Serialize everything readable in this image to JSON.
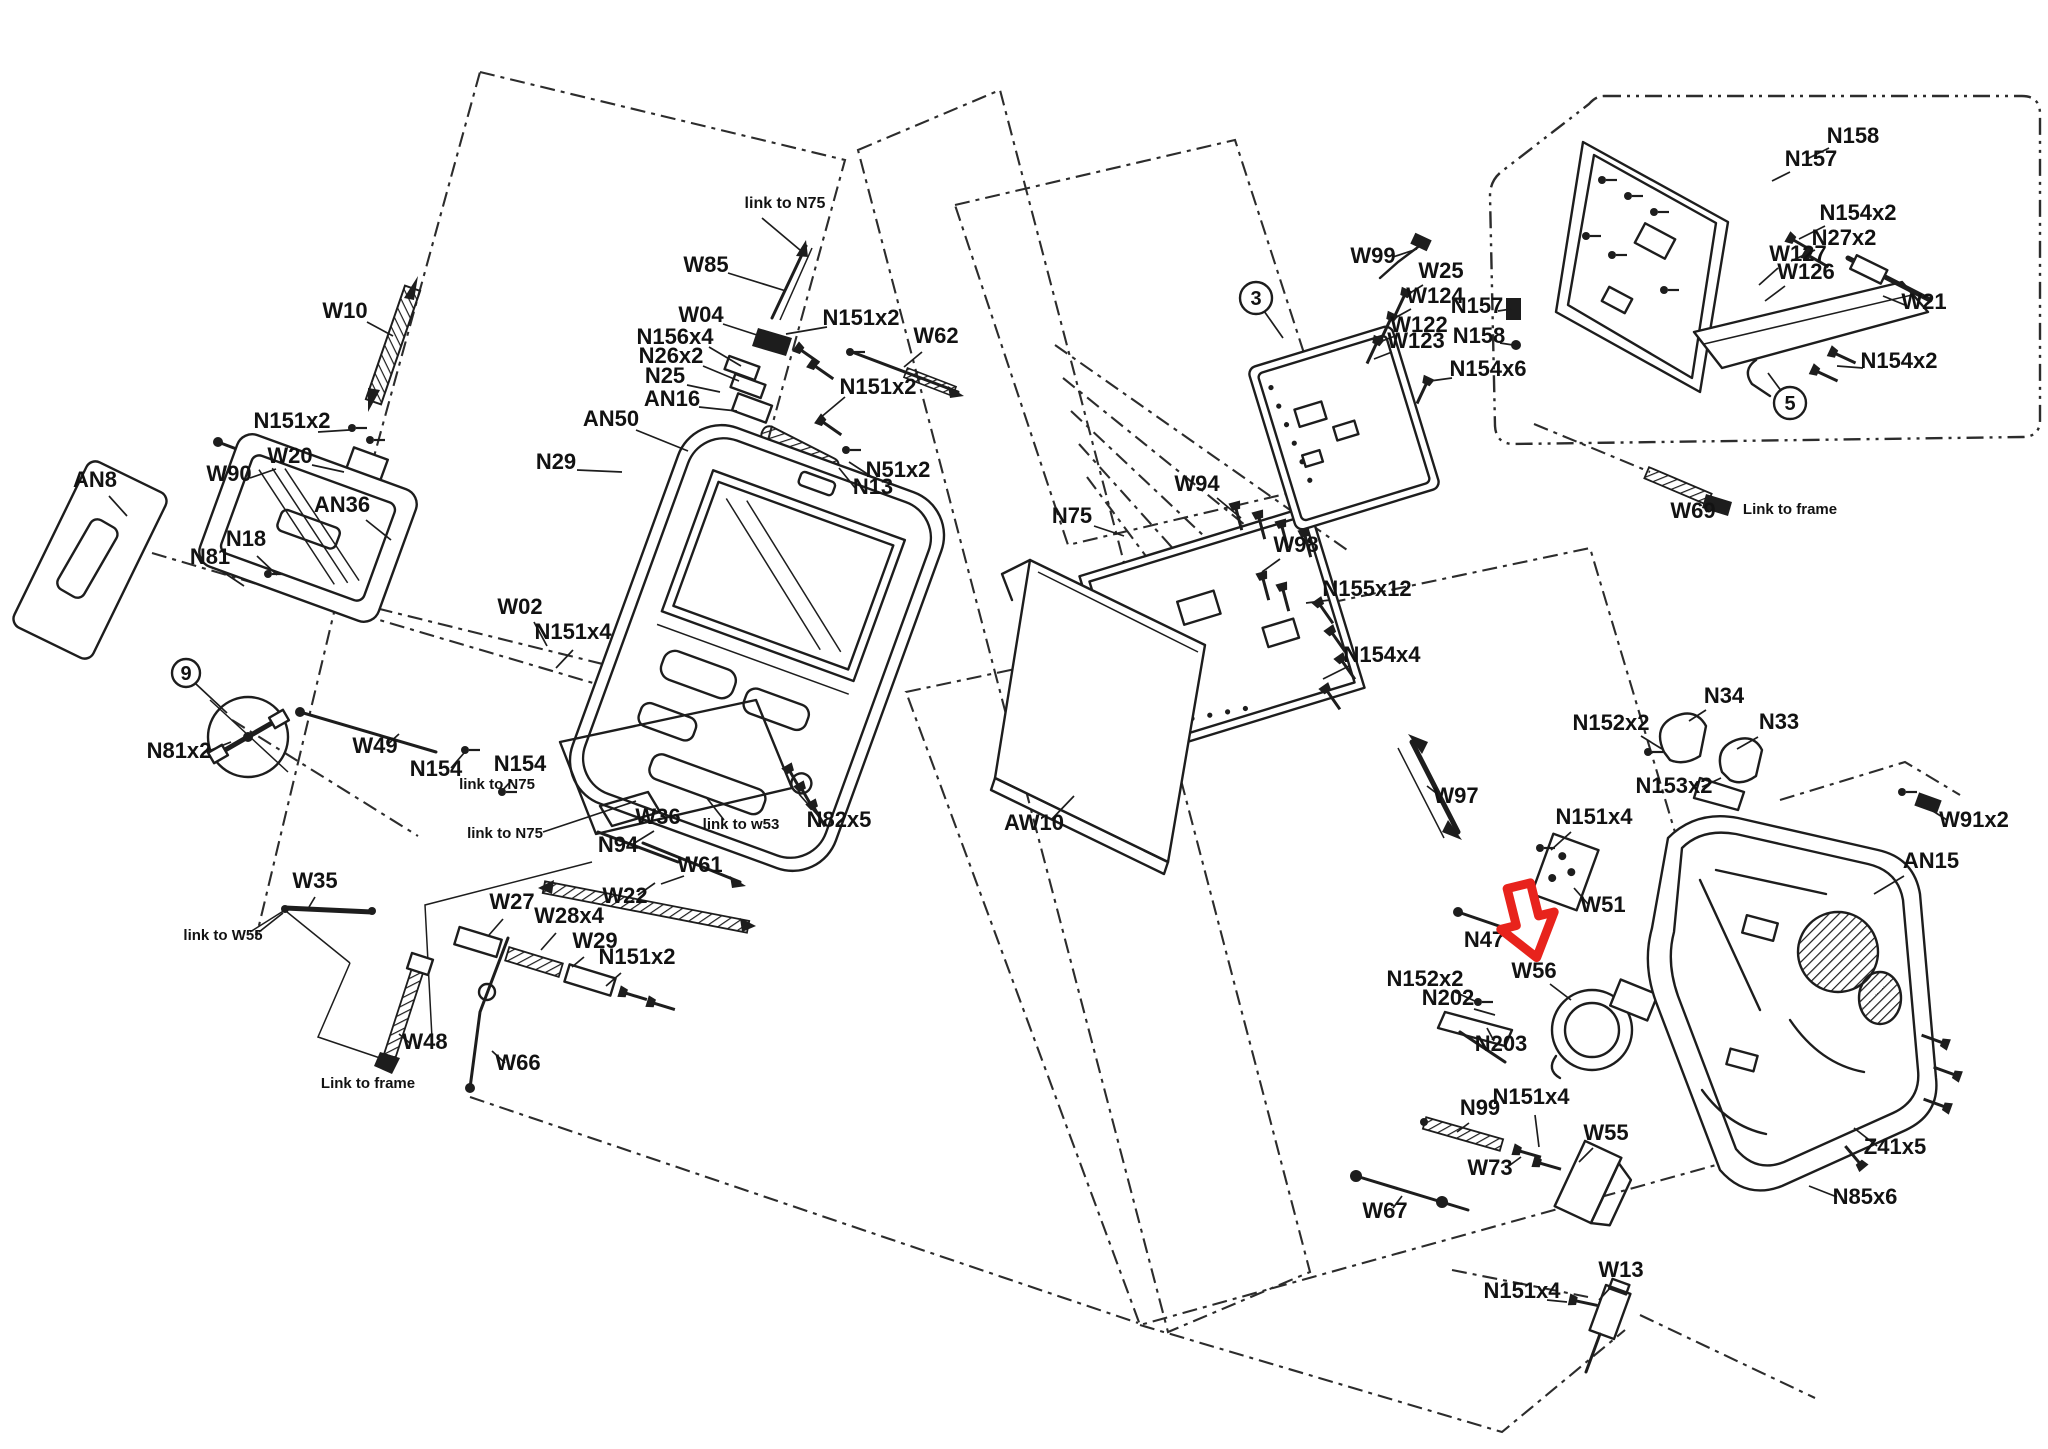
{
  "figure": {
    "type": "exploded-parts-diagram",
    "background": "#ffffff",
    "ink_color": "#1d1d1d",
    "highlight_color": "#e8231c",
    "highlighted_part": "W56"
  },
  "red_arrow": {
    "x": 1527,
    "y": 927,
    "rotate": -14
  },
  "callouts": [
    {
      "t": "3",
      "x": 1256,
      "y": 298,
      "r": 16
    },
    {
      "t": "5",
      "x": 1790,
      "y": 403,
      "r": 16
    },
    {
      "t": "9",
      "x": 186,
      "y": 673,
      "r": 14
    }
  ],
  "callout_leaders": [
    [
      1264,
      311,
      1283,
      338
    ],
    [
      1782,
      392,
      1768,
      373
    ],
    [
      196,
      684,
      227,
      713
    ]
  ],
  "labels": [
    {
      "t": "link to N75",
      "x": 785,
      "y": 208,
      "s": 16
    },
    {
      "t": "W85",
      "x": 706,
      "y": 272,
      "s": 22
    },
    {
      "t": "W10",
      "x": 345,
      "y": 318,
      "s": 22
    },
    {
      "t": "W04",
      "x": 701,
      "y": 322,
      "s": 22
    },
    {
      "t": "N151x2",
      "x": 861,
      "y": 325,
      "s": 22
    },
    {
      "t": "W62",
      "x": 936,
      "y": 343,
      "s": 22
    },
    {
      "t": "N156x4",
      "x": 675,
      "y": 344,
      "s": 22
    },
    {
      "t": "N26x2",
      "x": 671,
      "y": 363,
      "s": 22
    },
    {
      "t": "N25",
      "x": 665,
      "y": 383,
      "s": 22
    },
    {
      "t": "AN16",
      "x": 672,
      "y": 406,
      "s": 22
    },
    {
      "t": "N151x2",
      "x": 878,
      "y": 394,
      "s": 22
    },
    {
      "t": "AN50",
      "x": 611,
      "y": 426,
      "s": 22
    },
    {
      "t": "N29",
      "x": 556,
      "y": 469,
      "s": 22
    },
    {
      "t": "N51x2",
      "x": 898,
      "y": 477,
      "s": 22
    },
    {
      "t": "N13",
      "x": 873,
      "y": 494,
      "s": 22
    },
    {
      "t": "N151x2",
      "x": 292,
      "y": 428,
      "s": 22
    },
    {
      "t": "W20",
      "x": 290,
      "y": 463,
      "s": 22
    },
    {
      "t": "W90",
      "x": 229,
      "y": 481,
      "s": 22
    },
    {
      "t": "AN8",
      "x": 95,
      "y": 487,
      "s": 22
    },
    {
      "t": "N18",
      "x": 246,
      "y": 546,
      "s": 22
    },
    {
      "t": "N81",
      "x": 210,
      "y": 564,
      "s": 22
    },
    {
      "t": "AN36",
      "x": 342,
      "y": 512,
      "s": 22
    },
    {
      "t": "W02",
      "x": 520,
      "y": 614,
      "s": 22
    },
    {
      "t": "N151x4",
      "x": 573,
      "y": 639,
      "s": 22
    },
    {
      "t": "N81x2",
      "x": 179,
      "y": 758,
      "s": 22
    },
    {
      "t": "W49",
      "x": 375,
      "y": 753,
      "s": 22
    },
    {
      "t": "N154",
      "x": 436,
      "y": 776,
      "s": 22
    },
    {
      "t": "link to N75",
      "x": 497,
      "y": 789,
      "s": 15
    },
    {
      "t": "N154",
      "x": 520,
      "y": 771,
      "s": 22
    },
    {
      "t": "link to N75",
      "x": 505,
      "y": 838,
      "s": 15
    },
    {
      "t": "W36",
      "x": 658,
      "y": 824,
      "s": 22
    },
    {
      "t": "link to w53",
      "x": 741,
      "y": 829,
      "s": 15
    },
    {
      "t": "N82x5",
      "x": 839,
      "y": 827,
      "s": 22
    },
    {
      "t": "N94",
      "x": 618,
      "y": 852,
      "s": 22
    },
    {
      "t": "W61",
      "x": 700,
      "y": 872,
      "s": 22
    },
    {
      "t": "W22",
      "x": 625,
      "y": 903,
      "s": 22
    },
    {
      "t": "W35",
      "x": 315,
      "y": 888,
      "s": 22
    },
    {
      "t": "link to W55",
      "x": 223,
      "y": 940,
      "s": 15
    },
    {
      "t": "W27",
      "x": 512,
      "y": 909,
      "s": 22
    },
    {
      "t": "W28x4",
      "x": 569,
      "y": 923,
      "s": 22
    },
    {
      "t": "W29",
      "x": 595,
      "y": 948,
      "s": 22
    },
    {
      "t": "N151x2",
      "x": 637,
      "y": 964,
      "s": 22
    },
    {
      "t": "W48",
      "x": 425,
      "y": 1049,
      "s": 22
    },
    {
      "t": "Link to frame",
      "x": 368,
      "y": 1088,
      "s": 15
    },
    {
      "t": "W66",
      "x": 518,
      "y": 1070,
      "s": 22
    },
    {
      "t": "N75",
      "x": 1072,
      "y": 523,
      "s": 22
    },
    {
      "t": "W94",
      "x": 1197,
      "y": 491,
      "s": 22
    },
    {
      "t": "W98",
      "x": 1296,
      "y": 552,
      "s": 22
    },
    {
      "t": "N155x12",
      "x": 1367,
      "y": 596,
      "s": 22
    },
    {
      "t": "N154x4",
      "x": 1382,
      "y": 662,
      "s": 22
    },
    {
      "t": "AW10",
      "x": 1034,
      "y": 830,
      "s": 22
    },
    {
      "t": "W99",
      "x": 1373,
      "y": 263,
      "s": 22
    },
    {
      "t": "W25",
      "x": 1441,
      "y": 278,
      "s": 22
    },
    {
      "t": "W124",
      "x": 1435,
      "y": 303,
      "s": 22
    },
    {
      "t": "W122",
      "x": 1419,
      "y": 332,
      "s": 22
    },
    {
      "t": "W123",
      "x": 1416,
      "y": 348,
      "s": 22
    },
    {
      "t": "N154x6",
      "x": 1488,
      "y": 376,
      "s": 22
    },
    {
      "t": "N157",
      "x": 1477,
      "y": 313,
      "s": 22
    },
    {
      "t": "N158",
      "x": 1479,
      "y": 343,
      "s": 22
    },
    {
      "t": "N158",
      "x": 1853,
      "y": 143,
      "s": 22
    },
    {
      "t": "N157",
      "x": 1811,
      "y": 166,
      "s": 22
    },
    {
      "t": "N154x2",
      "x": 1858,
      "y": 220,
      "s": 22
    },
    {
      "t": "N27x2",
      "x": 1844,
      "y": 245,
      "s": 22
    },
    {
      "t": "W127",
      "x": 1798,
      "y": 261,
      "s": 22
    },
    {
      "t": "W126",
      "x": 1806,
      "y": 279,
      "s": 22
    },
    {
      "t": "W21",
      "x": 1924,
      "y": 309,
      "s": 22
    },
    {
      "t": "N154x2",
      "x": 1899,
      "y": 368,
      "s": 22
    },
    {
      "t": "W69",
      "x": 1693,
      "y": 518,
      "s": 22
    },
    {
      "t": "Link to frame",
      "x": 1790,
      "y": 514,
      "s": 15
    },
    {
      "t": "W97",
      "x": 1456,
      "y": 803,
      "s": 22
    },
    {
      "t": "N152x2",
      "x": 1611,
      "y": 730,
      "s": 22
    },
    {
      "t": "N34",
      "x": 1724,
      "y": 703,
      "s": 22
    },
    {
      "t": "N33",
      "x": 1779,
      "y": 729,
      "s": 22
    },
    {
      "t": "N153x2",
      "x": 1674,
      "y": 793,
      "s": 22
    },
    {
      "t": "W91x2",
      "x": 1974,
      "y": 827,
      "s": 22
    },
    {
      "t": "AN15",
      "x": 1931,
      "y": 868,
      "s": 22
    },
    {
      "t": "N151x4",
      "x": 1594,
      "y": 824,
      "s": 22
    },
    {
      "t": "W51",
      "x": 1603,
      "y": 912,
      "s": 22
    },
    {
      "t": "N47",
      "x": 1484,
      "y": 947,
      "s": 22
    },
    {
      "t": "W56",
      "x": 1534,
      "y": 978,
      "s": 22
    },
    {
      "t": "N152x2",
      "x": 1425,
      "y": 986,
      "s": 22
    },
    {
      "t": "N202",
      "x": 1448,
      "y": 1005,
      "s": 22
    },
    {
      "t": "N203",
      "x": 1501,
      "y": 1051,
      "s": 22
    },
    {
      "t": "N99",
      "x": 1480,
      "y": 1115,
      "s": 22
    },
    {
      "t": "N151x4",
      "x": 1531,
      "y": 1104,
      "s": 22
    },
    {
      "t": "W55",
      "x": 1606,
      "y": 1140,
      "s": 22
    },
    {
      "t": "W73",
      "x": 1490,
      "y": 1175,
      "s": 22
    },
    {
      "t": "W67",
      "x": 1385,
      "y": 1218,
      "s": 22
    },
    {
      "t": "W13",
      "x": 1621,
      "y": 1277,
      "s": 22
    },
    {
      "t": "N151x4",
      "x": 1522,
      "y": 1298,
      "s": 22
    },
    {
      "t": "Z41x5",
      "x": 1895,
      "y": 1154,
      "s": 22
    },
    {
      "t": "N85x6",
      "x": 1865,
      "y": 1204,
      "s": 22
    }
  ],
  "leaders": [
    [
      762,
      218,
      800,
      250
    ],
    [
      728,
      273,
      786,
      291
    ],
    [
      367,
      322,
      393,
      336
    ],
    [
      723,
      324,
      760,
      336
    ],
    [
      827,
      327,
      786,
      334
    ],
    [
      922,
      352,
      904,
      367
    ],
    [
      709,
      347,
      741,
      366
    ],
    [
      703,
      366,
      739,
      381
    ],
    [
      687,
      385,
      720,
      392
    ],
    [
      699,
      407,
      737,
      411
    ],
    [
      845,
      397,
      820,
      418
    ],
    [
      636,
      430,
      688,
      451
    ],
    [
      577,
      470,
      622,
      472
    ],
    [
      872,
      477,
      849,
      462
    ],
    [
      856,
      489,
      839,
      468
    ],
    [
      318,
      432,
      349,
      430
    ],
    [
      312,
      465,
      344,
      472
    ],
    [
      250,
      478,
      276,
      469
    ],
    [
      109,
      496,
      127,
      516
    ],
    [
      257,
      556,
      277,
      575
    ],
    [
      223,
      572,
      244,
      586
    ],
    [
      366,
      520,
      391,
      540
    ],
    [
      534,
      622,
      547,
      646
    ],
    [
      573,
      650,
      556,
      668
    ],
    [
      206,
      752,
      231,
      742
    ],
    [
      387,
      745,
      399,
      734
    ],
    [
      451,
      768,
      464,
      753
    ],
    [
      512,
      780,
      501,
      792
    ],
    [
      543,
      832,
      636,
      801
    ],
    [
      724,
      820,
      706,
      797
    ],
    [
      821,
      819,
      799,
      794
    ],
    [
      633,
      844,
      654,
      831
    ],
    [
      684,
      876,
      661,
      884
    ],
    [
      638,
      895,
      655,
      883
    ],
    [
      315,
      897,
      309,
      907
    ],
    [
      259,
      932,
      283,
      913
    ],
    [
      503,
      919,
      489,
      935
    ],
    [
      556,
      933,
      541,
      950
    ],
    [
      584,
      957,
      572,
      967
    ],
    [
      621,
      973,
      606,
      986
    ],
    [
      411,
      1044,
      399,
      1034
    ],
    [
      505,
      1063,
      492,
      1051
    ],
    [
      1094,
      526,
      1124,
      536
    ],
    [
      1217,
      498,
      1241,
      518
    ],
    [
      1280,
      559,
      1262,
      572
    ],
    [
      1330,
      600,
      1306,
      603
    ],
    [
      1349,
      666,
      1323,
      679
    ],
    [
      1051,
      820,
      1074,
      796
    ],
    [
      1393,
      257,
      1417,
      249
    ],
    [
      1423,
      285,
      1405,
      296
    ],
    [
      1411,
      309,
      1393,
      319
    ],
    [
      1395,
      336,
      1377,
      343
    ],
    [
      1392,
      352,
      1374,
      359
    ],
    [
      1452,
      378,
      1430,
      381
    ],
    [
      1498,
      311,
      1511,
      309
    ],
    [
      1500,
      343,
      1513,
      345
    ],
    [
      1829,
      148,
      1807,
      159
    ],
    [
      1790,
      172,
      1772,
      181
    ],
    [
      1825,
      226,
      1799,
      239
    ],
    [
      1815,
      250,
      1791,
      261
    ],
    [
      1778,
      268,
      1759,
      285
    ],
    [
      1785,
      286,
      1765,
      301
    ],
    [
      1905,
      305,
      1883,
      296
    ],
    [
      1863,
      368,
      1837,
      366
    ],
    [
      1706,
      512,
      1715,
      503
    ],
    [
      1440,
      796,
      1427,
      786
    ],
    [
      1641,
      736,
      1662,
      749
    ],
    [
      1706,
      710,
      1689,
      721
    ],
    [
      1758,
      737,
      1737,
      749
    ],
    [
      1702,
      787,
      1721,
      778
    ],
    [
      1947,
      820,
      1925,
      806
    ],
    [
      1904,
      876,
      1874,
      894
    ],
    [
      1571,
      832,
      1551,
      850
    ],
    [
      1588,
      904,
      1574,
      888
    ],
    [
      1499,
      938,
      1512,
      928
    ],
    [
      1550,
      984,
      1571,
      1000
    ],
    [
      1455,
      992,
      1477,
      1002
    ],
    [
      1474,
      1009,
      1495,
      1015
    ],
    [
      1494,
      1041,
      1487,
      1028
    ],
    [
      1469,
      1123,
      1457,
      1132
    ],
    [
      1535,
      1115,
      1539,
      1147
    ],
    [
      1593,
      1148,
      1579,
      1162
    ],
    [
      1506,
      1168,
      1521,
      1157
    ],
    [
      1393,
      1208,
      1402,
      1196
    ],
    [
      1611,
      1287,
      1599,
      1300
    ],
    [
      1547,
      1300,
      1567,
      1302
    ],
    [
      1877,
      1146,
      1854,
      1128
    ],
    [
      1837,
      1197,
      1809,
      1186
    ]
  ]
}
